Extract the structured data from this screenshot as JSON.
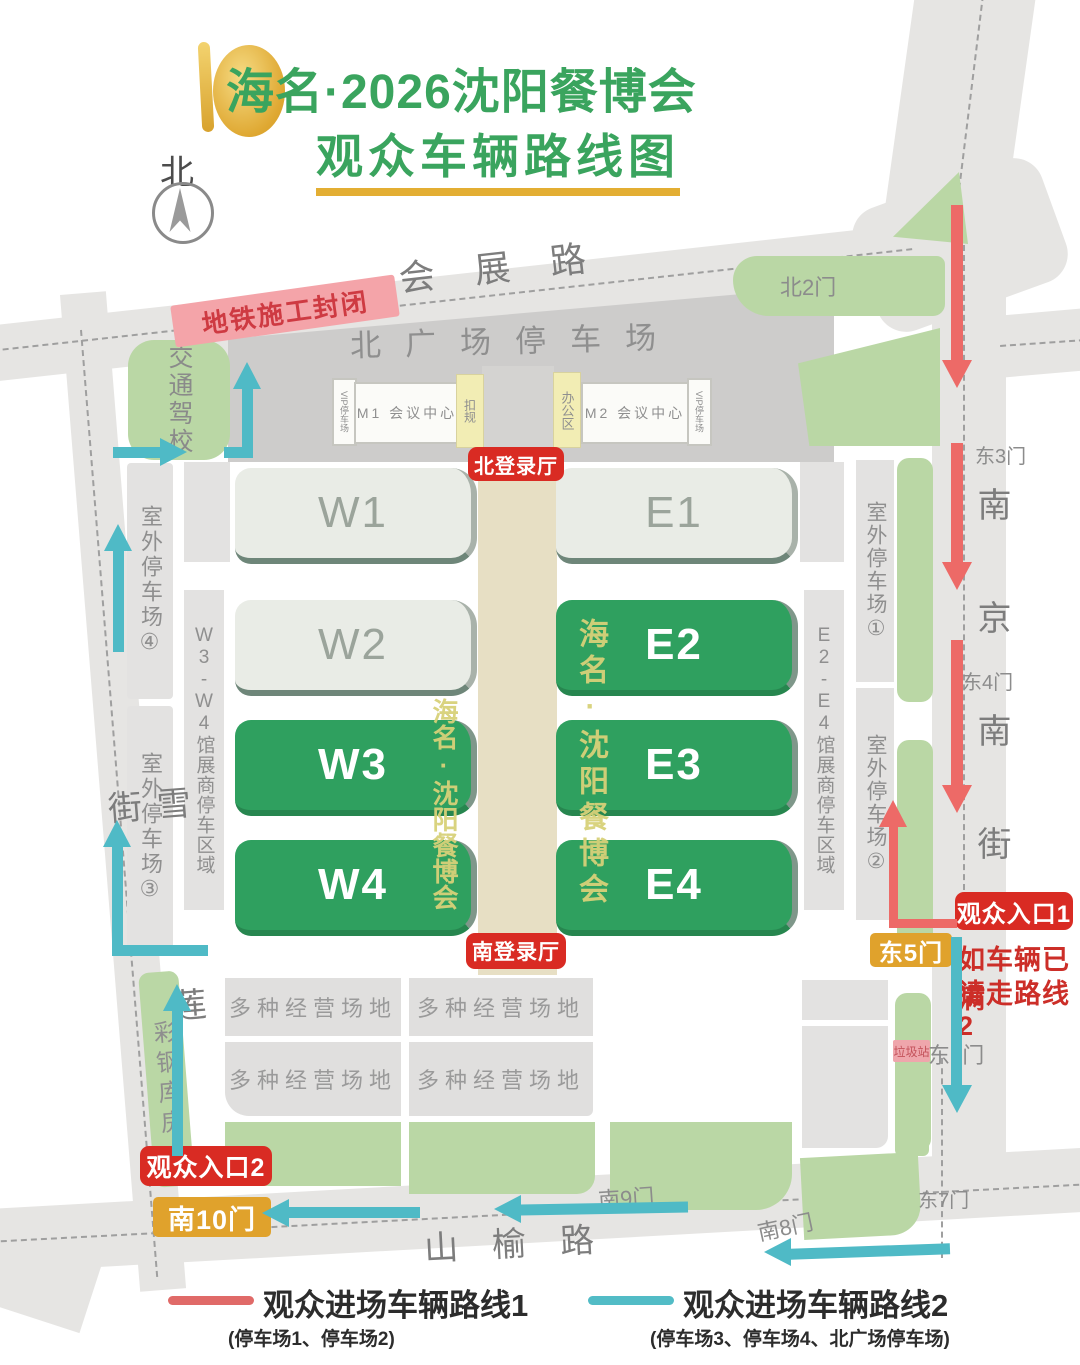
{
  "title": {
    "line1": "海名·2026沈阳餐博会",
    "line2": "观众车辆路线图"
  },
  "compass": {
    "label": "北"
  },
  "roads": {
    "top": "会展路",
    "left": "雪莲街",
    "right": "南京南街",
    "bottom": "山榆路"
  },
  "areas": {
    "north_plaza": "北广场停车场",
    "subway_closed": "地铁施工封闭",
    "driving_school": "交通驾校",
    "steel_warehouse": "彩钢库房",
    "multi_business": "多种经营场地",
    "garbage_station": "垃圾站"
  },
  "facility_strip": {
    "vip_left": "VIP停车场",
    "m1": "M1 会议中心",
    "box_left": "扣规",
    "office": "办公区",
    "m2": "M2 会议中心",
    "vip_right": "VIP停车场"
  },
  "lobbies": {
    "north": "北登录厅",
    "south": "南登录厅"
  },
  "halls": {
    "w1": "W1",
    "e1": "E1",
    "w2": "W2",
    "e2": "E2",
    "w3": "W3",
    "e3": "E3",
    "w4": "W4",
    "e4": "E4"
  },
  "watermark": "海名·沈阳餐博会",
  "parking": {
    "outdoor1": "室外停车场①",
    "outdoor2": "室外停车场②",
    "outdoor3": "室外停车场③",
    "outdoor4": "室外停车场④",
    "w_exhibitor": "W3-W4馆展商停车区域",
    "e_exhibitor": "E2-E4馆展商停车区域"
  },
  "gates": {
    "north2": "北2门",
    "east3": "东3门",
    "east4": "东4门",
    "east5": "东5门",
    "east6": "东6门",
    "east7": "东7门",
    "south8": "南8门",
    "south9": "南9门",
    "south10": "南10门"
  },
  "entrances": {
    "entrance1": "观众入口1",
    "entrance2": "观众入口2"
  },
  "route_notice": {
    "line1": "如车辆已满",
    "line2": "请走路线2"
  },
  "legend": {
    "route1": "观众进场车辆路线1",
    "route1_sub": "(停车场1、停车场2)",
    "route2": "观众进场车辆路线2",
    "route2_sub": "(停车场3、停车场4、北广场停车场)"
  },
  "colors": {
    "route1_red": "#ed6a67",
    "route2_teal": "#4fbac6",
    "hall_green": "#2fa05f",
    "pale_hall": "#e9ece6",
    "badge_red": "#d92b23",
    "badge_gold": "#e0a22c",
    "area_green": "#bad7a5",
    "road_gray": "#e6e5e3",
    "notice_pink": "#f4a4a9"
  }
}
